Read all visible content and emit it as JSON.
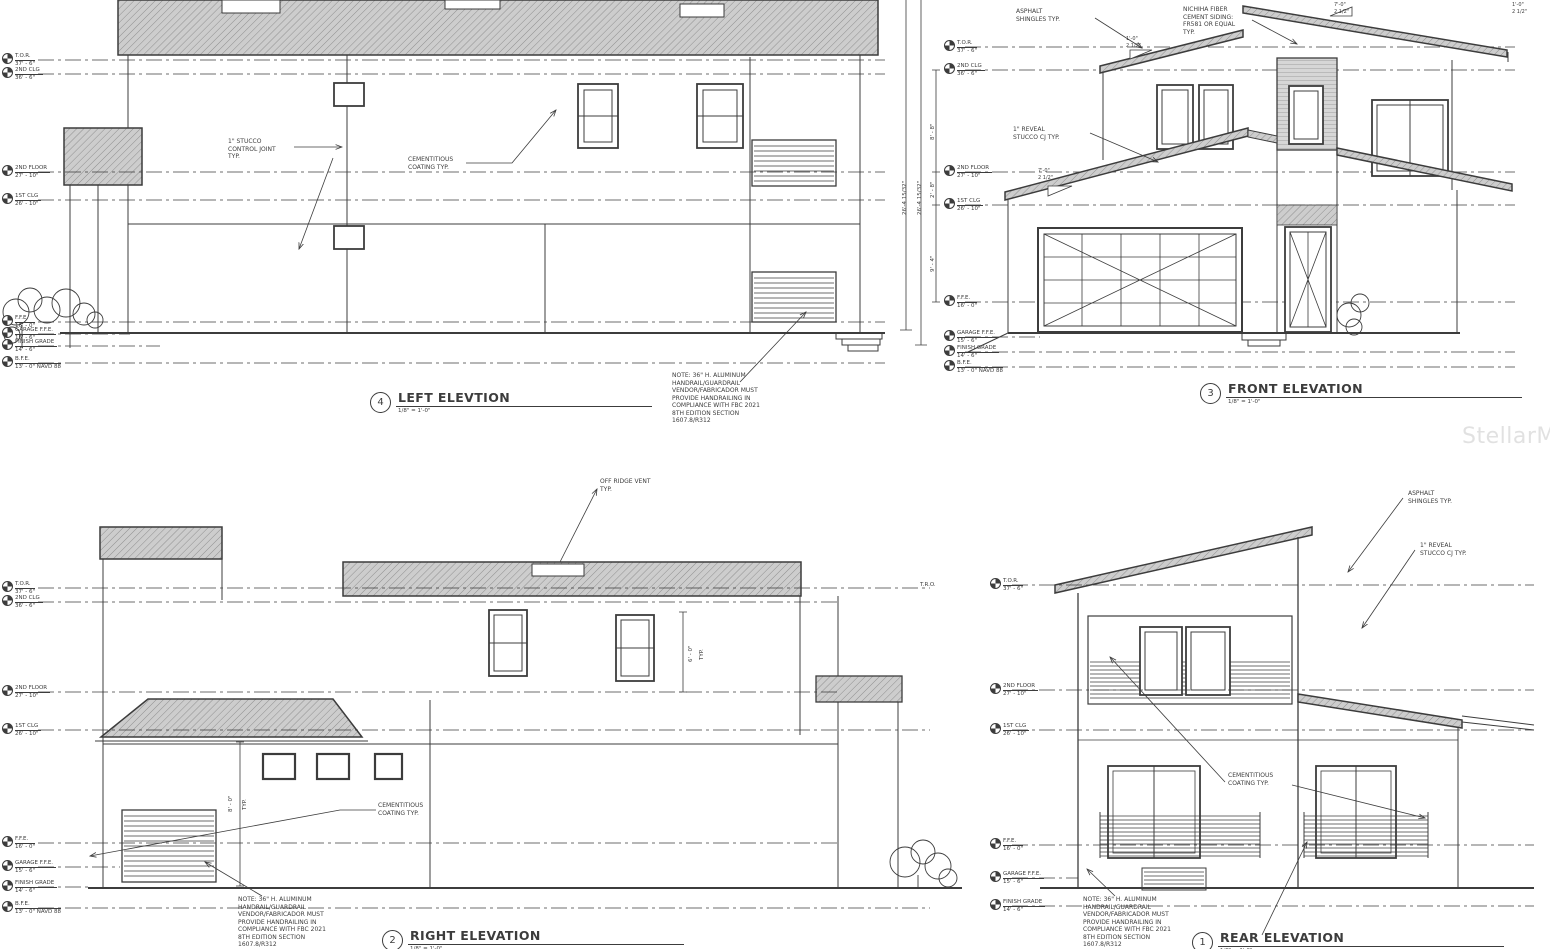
{
  "watermark": "StellarMLS",
  "titles": {
    "left": {
      "num": "4",
      "title": "LEFT ELEVTION",
      "scale": "1/8\" = 1'-0\""
    },
    "front": {
      "num": "3",
      "title": "FRONT ELEVATION",
      "scale": "1/8\" = 1'-0\""
    },
    "right": {
      "num": "2",
      "title": "RIGHT ELEVATION",
      "scale": "1/8\" = 1'-0\""
    },
    "rear": {
      "num": "1",
      "title": "REAR ELEVATION",
      "scale": "1/8\" = 1'-0\""
    }
  },
  "datums": [
    {
      "label": "T.O.R.",
      "value": "37' - 6\""
    },
    {
      "label": "2ND CLG",
      "value": "36' - 6\""
    },
    {
      "label": "2ND FLOOR",
      "value": "27' - 10\""
    },
    {
      "label": "1ST CLG",
      "value": "26' - 10\""
    },
    {
      "label": "F.F.E.",
      "value": "16' - 0\""
    },
    {
      "label": "GARAGE F.F.E.",
      "value": "15' - 6\""
    },
    {
      "label": "FINISH GRADE",
      "value": "14' - 6\""
    },
    {
      "label": "B.F.E.",
      "value": "13' - 0\" NAVD 88"
    }
  ],
  "notes": {
    "stucco_joint": "1\" STUCCO\nCONTROL JOINT\nTYP.",
    "cementitious": "CEMENTITIOUS\nCOATING TYP.",
    "handrail": "NOTE: 36\" H. ALUMINUM\nHANDRAIL/GUARDRAIL\nVENDOR/FABRICADOR MUST\nPROVIDE HANDRAILING IN\nCOMPLIANCE WITH FBC 2021\n8TH EDITION SECTION\n1607.8/R312",
    "off_ridge_vent": "OFF RIDGE VENT\nTYP.",
    "asphalt_shingles": "ASPHALT\nSHINGLES TYP.",
    "nichiha": "NICHIHA FIBER\nCEMENT SIDING:\nFR581 OR EQUAL\nTYP.",
    "reveal": "1\" REVEAL\nSTUCCO CJ TYP.",
    "tro": "T.R.O."
  },
  "dims": {
    "overall_height": "26'-4 15/32\"",
    "d8_8": "8' - 8\"",
    "d2_8": "2' - 8\"",
    "d9_4": "9' - 4\"",
    "d8_0": "8' - 0\"",
    "d6_0": "6' - 0\"",
    "typ": "TYP.",
    "slope_a": "7'-0\"\n2 1/2\"",
    "slope_b": "1'-0\"\n2 1/2\""
  }
}
